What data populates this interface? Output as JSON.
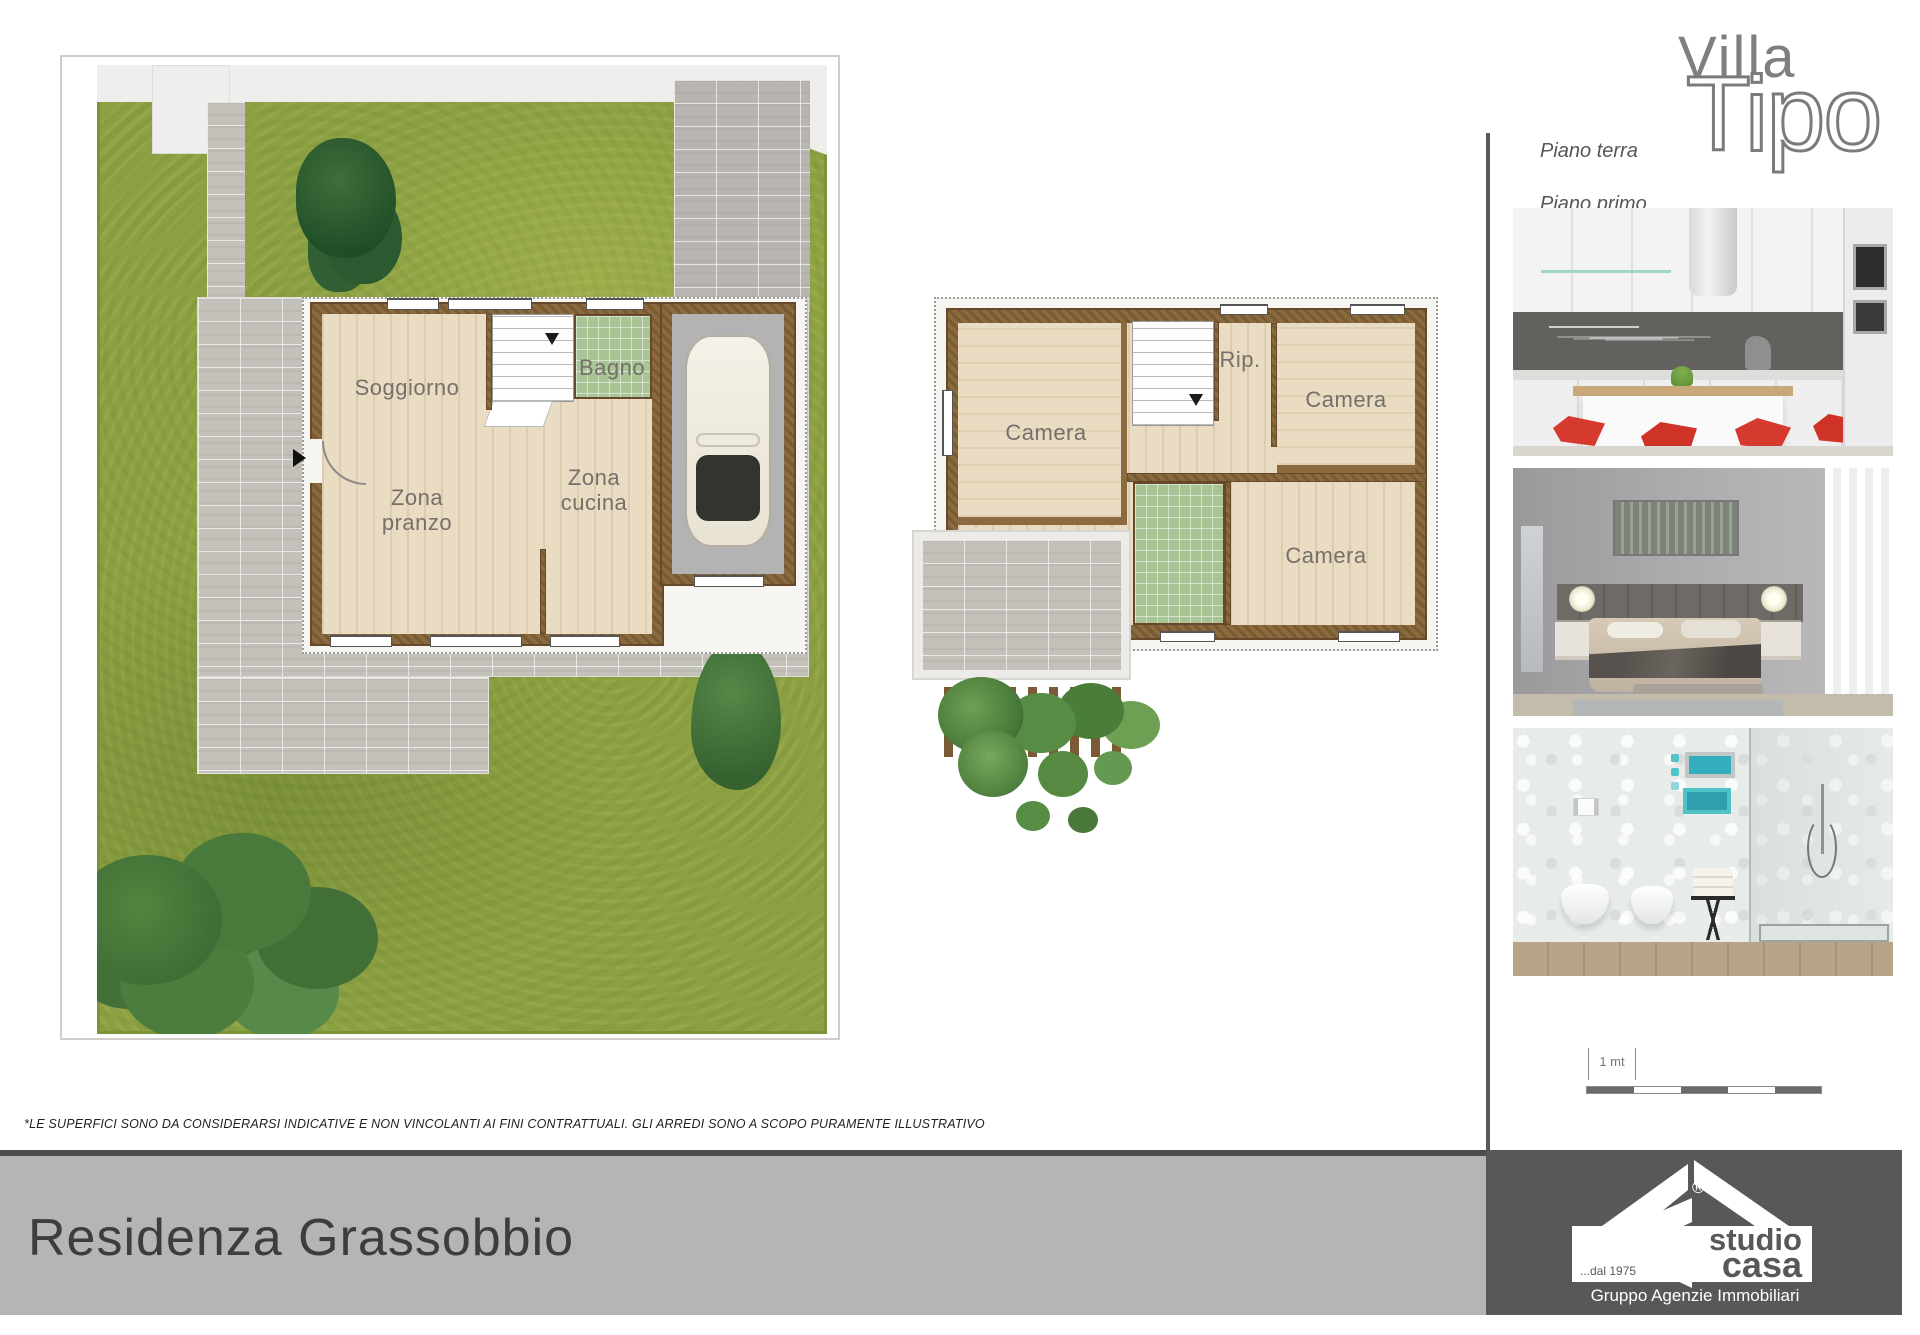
{
  "header": {
    "brand_line1": "Villa",
    "brand_line2": "Tipo",
    "floor_label_1": "Piano terra",
    "floor_label_2": "Piano primo"
  },
  "ground_floor": {
    "soggiorno": "Soggiorno",
    "bagno": "Bagno",
    "zona_pranzo": "Zona\npranzo",
    "zona_cucina": "Zona\ncucina"
  },
  "first_floor": {
    "camera_1": "Camera",
    "rip": "Rip.",
    "camera_2": "Camera",
    "camera_3": "Camera"
  },
  "scale_bar": {
    "label": "1 mt"
  },
  "disclaimer": "*LE SUPERFICI SONO DA CONSIDERARSI INDICATIVE E NON VINCOLANTI AI FINI CONTRATTUALI.  GLI ARREDI SONO A SCOPO PURAMENTE ILLUSTRATIVO",
  "footer": {
    "title": "Residenza Grassobbio"
  },
  "logo": {
    "studio": "studio",
    "casa": "casa",
    "since": "...dal 1975",
    "group": "Gruppo Agenzie Immobiliari",
    "registered": "®"
  },
  "photos": [
    {
      "name": "kitchen"
    },
    {
      "name": "bedroom"
    },
    {
      "name": "bathroom"
    }
  ],
  "colors": {
    "grass_green": "#8ca043",
    "wall_brown": "#8a6a3e",
    "tile_green": "#a9c595",
    "floor_beige": "#e9dcc2",
    "paving_gray": "#c4c0ba",
    "footer_band": "#b5b5b6",
    "footer_dark": "#57585a",
    "chair_red": "#d63a2f",
    "text_gray": "#757069"
  }
}
